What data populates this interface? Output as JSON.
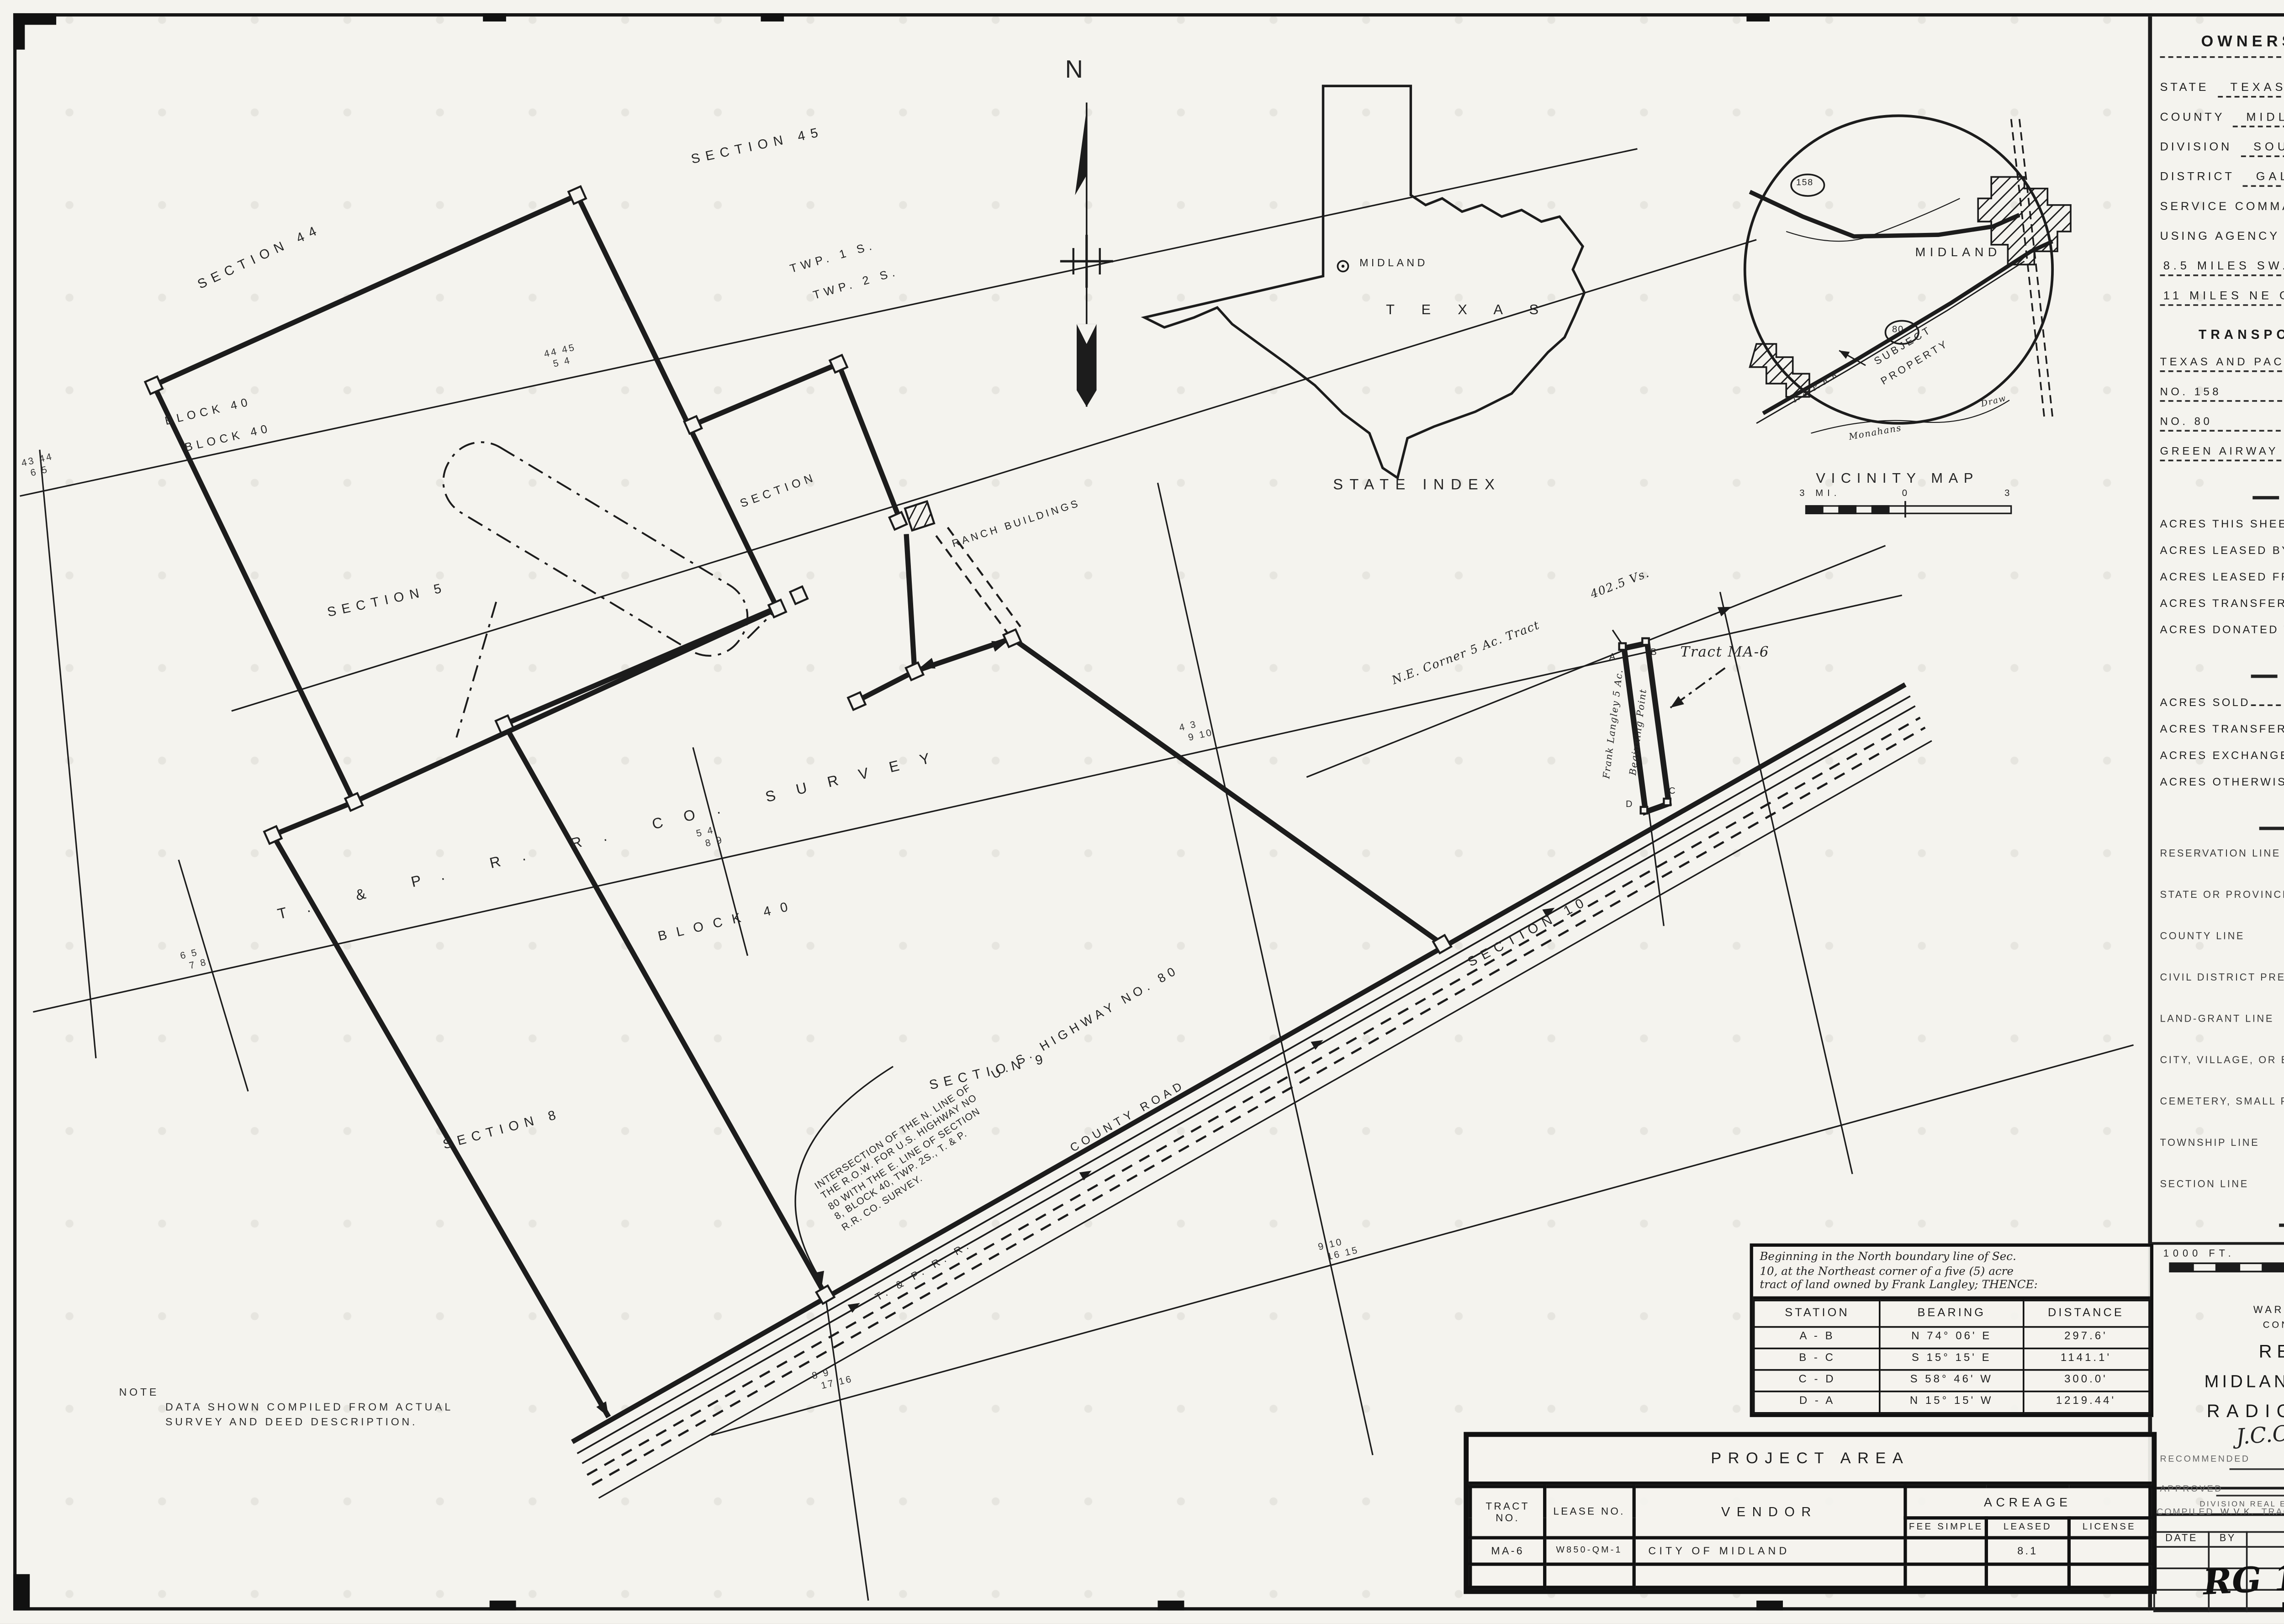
{
  "panel": {
    "title": "OWNERSHIP - TRACT MAP",
    "subtitle": "(TYPE OF MAP)",
    "fields": [
      {
        "label": "STATE",
        "value": "TEXAS"
      },
      {
        "label": "COUNTY",
        "value": "MIDLAND"
      },
      {
        "label": "DIVISION",
        "value": "SOUTHWESTERN"
      },
      {
        "label": "DISTRICT",
        "value": "GALVESTON"
      },
      {
        "label": "SERVICE COMMAND",
        "value": "EIGHTH"
      },
      {
        "label": "USING AGENCY",
        "value": "AIR FORCES"
      }
    ],
    "distance1": "8.5 MILES SW. OF MIDLAND",
    "distance2": "11 MILES NE OF ODESSA"
  },
  "transportation": {
    "title": "TRANSPORTATION FACILITIES",
    "rows": [
      {
        "value": "TEXAS AND PACIFIC",
        "label": "RAILROAD"
      },
      {
        "value": "NO. 158",
        "label": "STATE ROAD"
      },
      {
        "value": "NO. 80",
        "label": "FEDERAL ROAD"
      },
      {
        "value": "GREEN AIRWAY NO. 5",
        "label": "AIRLINE"
      }
    ]
  },
  "land_area": {
    "title": "LAND AREA",
    "rows": [
      {
        "label": "ACRES THIS SHEET",
        "value": "8.1"
      },
      {
        "label": "ACRES LEASED BY W.D.",
        "value": "8.1"
      },
      {
        "label": "ACRES LEASED FROM W.D.",
        "value": ""
      },
      {
        "label": "ACRES TRANSFERRED TO W.D.",
        "value": ""
      },
      {
        "label": "ACRES DONATED TO W.D.",
        "value": ""
      }
    ]
  },
  "disposals": {
    "title": "DISPOSALS",
    "rows": [
      {
        "label": "ACRES SOLD"
      },
      {
        "label": "ACRES TRANSFERRED"
      },
      {
        "label": "ACRES EXCHANGED"
      },
      {
        "label": "ACRES OTHERWISE"
      }
    ]
  },
  "legend": {
    "title": "LEGEND",
    "items": [
      "RESERVATION LINE",
      "STATE OR PROVINCE LINE",
      "COUNTY LINE",
      "CIVIL DISTRICT PRECINCT",
      "LAND-GRANT LINE",
      "CITY, VILLAGE, OR BOROUGH",
      "CEMETERY, SMALL PARK ETC",
      "TOWNSHIP LINE",
      "SECTION LINE"
    ]
  },
  "panel_scale": {
    "title": "SCALE",
    "labels": [
      "1000 FT.",
      "0",
      "1000",
      "2000"
    ]
  },
  "title_block": {
    "dept1": "WAR DEPARTMENT, O.C.E.",
    "dept2": "CONSTRUCTION DIVISION",
    "line1": "REAL ESTATE",
    "line2": "MIDLAND ARMY AIRFIELD",
    "line3": "RADIO RANGE SITE",
    "recommended": "RECOMMENDED",
    "signature": "J.C.Coryell",
    "date_label": "DATE:",
    "date": "May 7 '47",
    "approved": "APPROVED",
    "date2_label": "DATE",
    "officer": "DIVISION REAL ESTATE OFFICER"
  },
  "credits": {
    "c1": "COMPILED",
    "v1": "W.V.K.",
    "c2": "TRACED",
    "v2": "J.S.K.",
    "c3": "CHECKED",
    "v3": "F.L.K."
  },
  "revisions": {
    "h": [
      "DATE",
      "BY",
      "REVISIONS",
      "APPROVED"
    ]
  },
  "rg": "RG 121",
  "description": {
    "intro": [
      "Beginning in the North boundary line of Sec.",
      "10, at the Northeast corner of a five (5) acre",
      "tract of land owned by Frank Langley; THENCE:"
    ],
    "headers": [
      "STATION",
      "BEARING",
      "DISTANCE"
    ],
    "rows": [
      [
        "A - B",
        "N 74° 06' E",
        "297.6'"
      ],
      [
        "B - C",
        "S 15° 15' E",
        "1141.1'"
      ],
      [
        "C - D",
        "S 58° 46' W",
        "300.0'"
      ],
      [
        "D - A",
        "N 15° 15' W",
        "1219.44'"
      ]
    ]
  },
  "project": {
    "title": "PROJECT AREA",
    "c_tract": "TRACT NO.",
    "c_lease": "LEASE NO.",
    "c_vendor": "VENDOR",
    "c_acreage": "ACREAGE",
    "c_fee": "FEE SIMPLE",
    "c_leased": "LEASED",
    "c_license": "LICENSE",
    "row": {
      "tract": "MA-6",
      "lease": "W850-QM-1",
      "vendor": "CITY OF MIDLAND",
      "fee": "",
      "leased": "8.1",
      "license": ""
    }
  },
  "map": {
    "north": "N",
    "sections": {
      "s45": "SECTION 45",
      "s44": "SECTION 44",
      "s5": "SECTION 5",
      "s4": "SECTION",
      "s8": "SECTION 8",
      "s9": "SECTION 9",
      "s10": "SECTION 10"
    },
    "twp1": "TWP. 1 S.",
    "twp2": "TWP. 2 S.",
    "block40_nw1": "BLOCK 40",
    "block40_nw2": "BLOCK 40",
    "block40_c": "BLOCK 40",
    "survey": "T. & P.  R. R.  CO.  SURVEY",
    "ranch": "RANCH BUILDINGS",
    "highway": "U. S. HIGHWAY  NO. 80",
    "county_road": "COUNTY   ROAD",
    "railroad": "T. & P.  R. R.",
    "ne_corner": "N.E. Corner 5 Ac. Tract",
    "vs": "402.5 Vs.",
    "tract": "Tract MA-6",
    "frank": "Frank Langley 5 Ac.",
    "begin": "Beginning Point",
    "corner_letters": {
      "a": "A",
      "b": "B",
      "c": "C",
      "d": "D"
    },
    "note": {
      "t": "NOTE",
      "l1": "DATA SHOWN COMPILED FROM ACTUAL",
      "l2": "SURVEY AND DEED DESCRIPTION."
    },
    "intersection": [
      "INTERSECTION OF THE N. LINE OF",
      "THE R.O.W. FOR U.S. HIGHWAY NO",
      "80 WITH THE E. LINE OF SECTION",
      "8, BLOCK 40, TWP. 2S., T. & P.",
      "R.R. CO. SURVEY."
    ],
    "xnums": [
      {
        "a": "43 44",
        "b": "6 5"
      },
      {
        "a": "44 45",
        "b": "5 4"
      },
      {
        "a": "5 4",
        "b": "8 9"
      },
      {
        "a": "6 5",
        "b": "7 8"
      },
      {
        "a": "4 3",
        "b": "9 10"
      },
      {
        "a": "8 9",
        "b": "17 16"
      },
      {
        "a": "9 10",
        "b": "16 15"
      }
    ]
  },
  "state_index": {
    "city": "MIDLAND",
    "state": "T E X A S",
    "caption": "STATE INDEX"
  },
  "vicinity": {
    "caption": "VICINITY MAP",
    "city": "MIDLAND",
    "subject1": "SUBJECT",
    "subject2": "PROPERTY",
    "rr": "T. & P.  R.R.",
    "monahans": "Monahans",
    "draw": "Draw",
    "r1": "158",
    "r2": "80",
    "scale": [
      "3 MI.",
      "0",
      "3"
    ]
  }
}
